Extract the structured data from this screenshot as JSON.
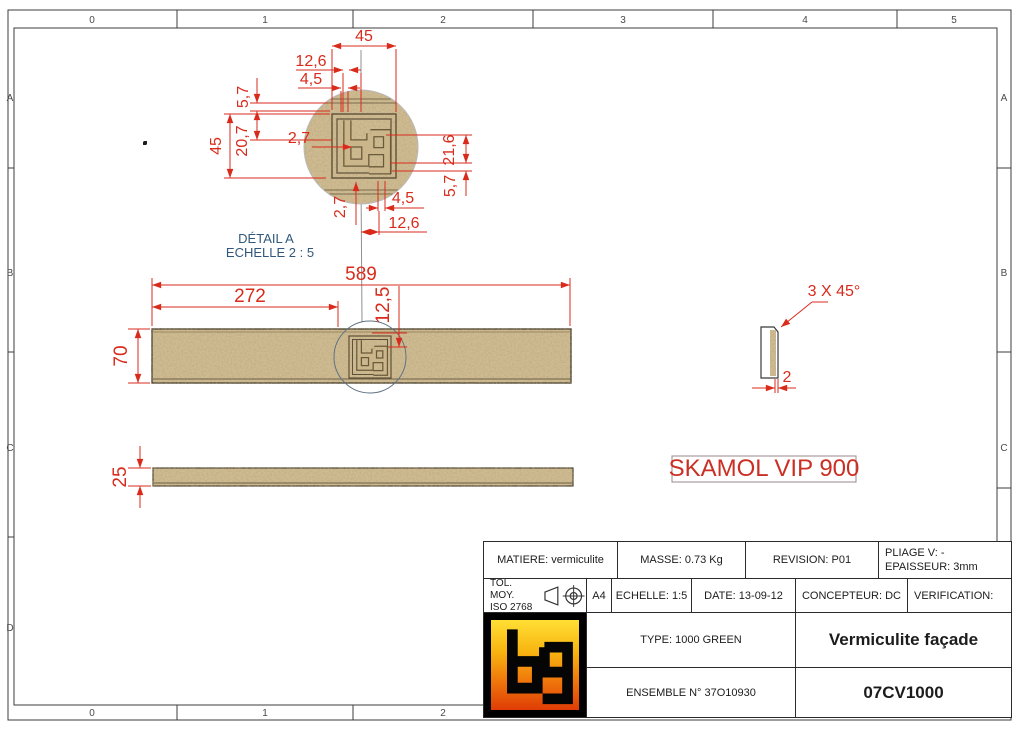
{
  "sheet": {
    "top_ruler": [
      "0",
      "1",
      "2",
      "3",
      "4",
      "5"
    ],
    "bottom_ruler": [
      "0",
      "1",
      "2"
    ],
    "row_labels": [
      "A",
      "B",
      "C",
      "D"
    ]
  },
  "detail_view": {
    "label_line1": "DÉTAIL A",
    "label_line2": "ECHELLE 2 : 5",
    "dims": {
      "logo_width": "45",
      "top_offset_1": "12,6",
      "top_offset_2": "4,5",
      "left_edge": "5,7",
      "left_depth": "20,7",
      "logo_height": "45",
      "slot_left": "2,7",
      "right_depth": "21,6",
      "right_edge": "5,7",
      "bottom_offset_2": "4,5",
      "bottom_offset_1": "12,6",
      "slot_bottom": "2,7"
    }
  },
  "plan_view": {
    "dims": {
      "length": "589",
      "logo_position": "272",
      "logo_offset": "12,5",
      "width": "70"
    }
  },
  "side_view": {
    "dims": {
      "thickness": "25"
    }
  },
  "end_view": {
    "dims": {
      "chamfer": "3 X 45°",
      "edge": "2"
    }
  },
  "stamp": {
    "text": "SKAMOL VIP 900"
  },
  "title_block": {
    "matiere": "MATIERE: vermiculite",
    "masse": "MASSE: 0.73 Kg",
    "revision": "REVISION: P01",
    "pliage": "PLIAGE V: -",
    "epaisseur": "EPAISSEUR: 3mm",
    "tol_line1": "TOL. MOY.",
    "tol_line2": "ISO 2768",
    "format": "A4",
    "echelle": "ECHELLE: 1:5",
    "date": "DATE: 13-09-12",
    "concepteur": "CONCEPTEUR: DC",
    "verification": "VERIFICATION:",
    "type": "TYPE: 1000 GREEN",
    "title": "Vermiculite façade",
    "ensemble": "ENSEMBLE N° 37O10930",
    "reference": "07CV1000"
  },
  "colors": {
    "dimension_red": "#d92b1c",
    "detail_blue": "#31587a",
    "stamp_red": "#cb2f24",
    "material_tan": "#cfbb92",
    "logo_gradient_top": "#ffdf35",
    "logo_gradient_bottom": "#e03c05"
  }
}
